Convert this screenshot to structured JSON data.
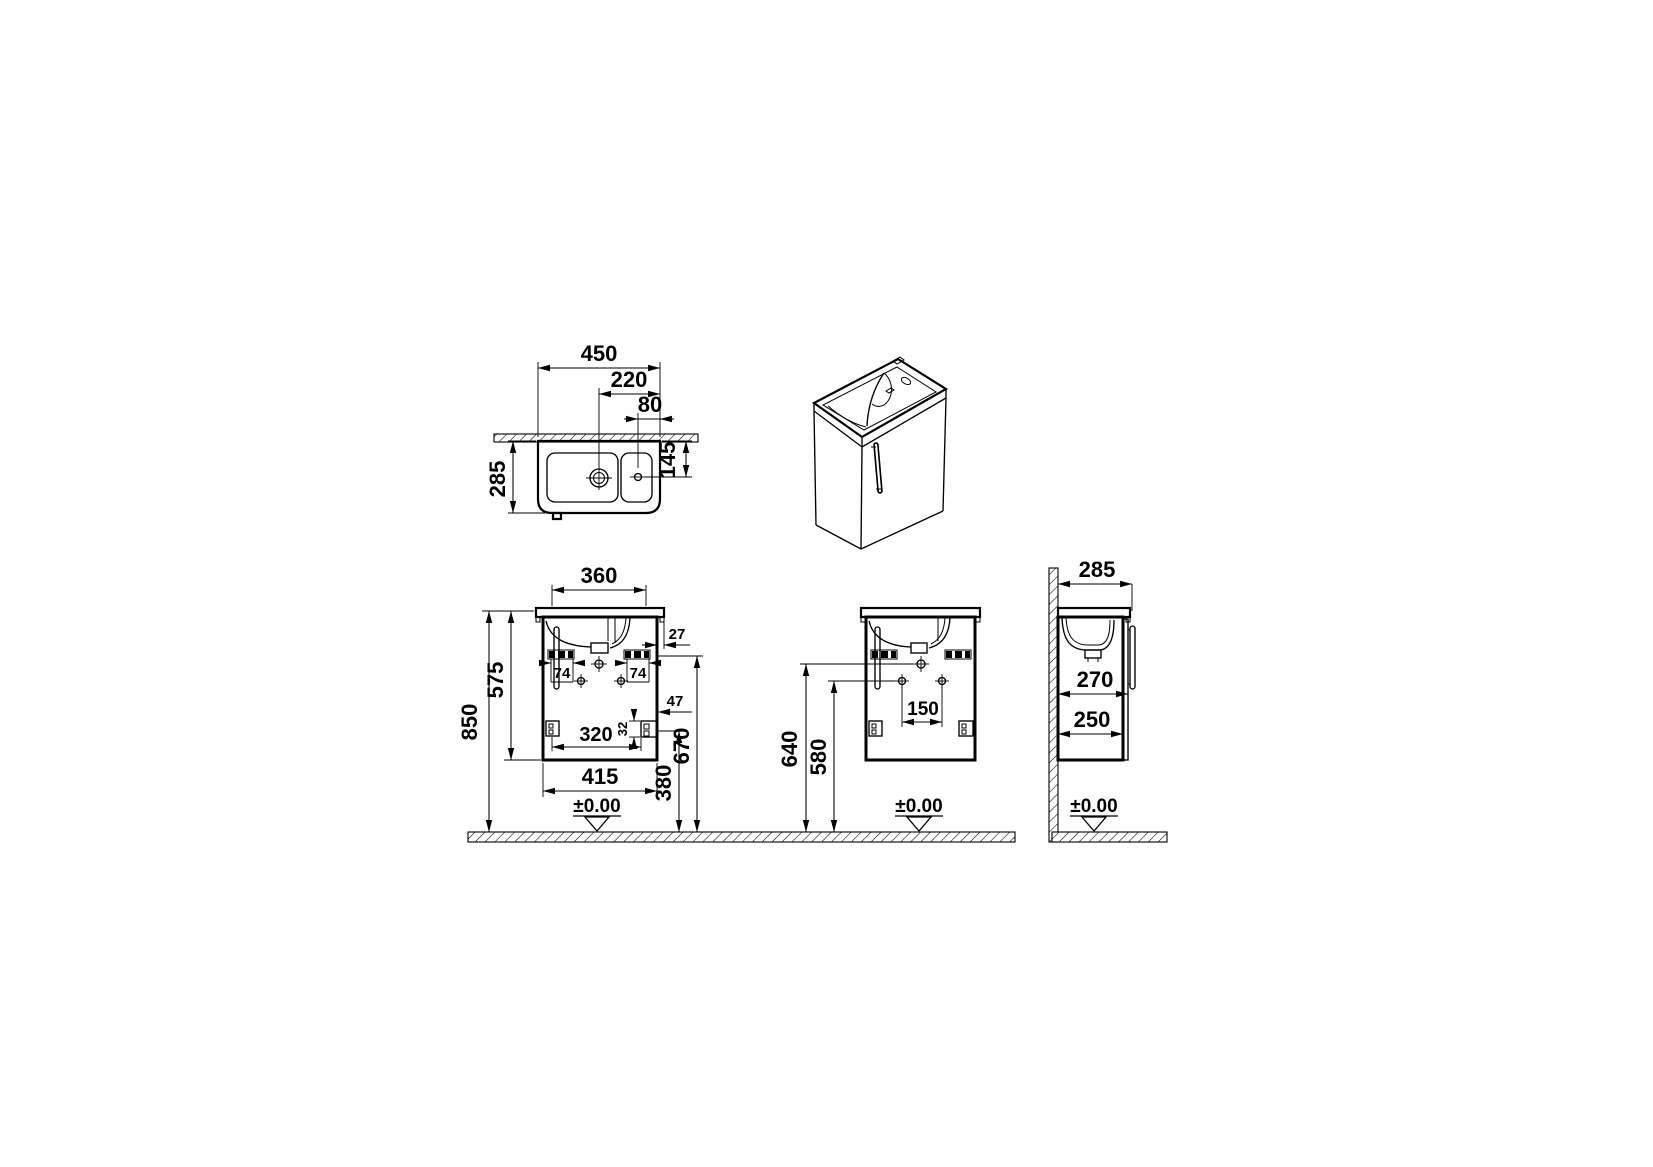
{
  "drawing": {
    "units": "mm",
    "top_view": {
      "width": "450",
      "drain_to_edge": "220",
      "tap_to_edge": "80",
      "depth": "285",
      "tap_from_wall": "145"
    },
    "front_view": {
      "basin_width": "360",
      "total_height": "850",
      "cabinet_height": "575",
      "rim_overhang": "27",
      "bracket_left": "74",
      "bracket_right": "74",
      "hinge_inset": "47",
      "hinge_plate": "32",
      "hinge_span": "320",
      "cabinet_width": "415",
      "hinge_height": "380",
      "bracket_height": "670",
      "floor_level": "±0.00"
    },
    "installation_view": {
      "top_hole_height": "640",
      "side_hole_height": "580",
      "hole_span": "150",
      "floor_level": "±0.00"
    },
    "side_view": {
      "depth": "285",
      "depth_with_door": "270",
      "cabinet_depth": "250",
      "floor_level": "±0.00"
    }
  }
}
